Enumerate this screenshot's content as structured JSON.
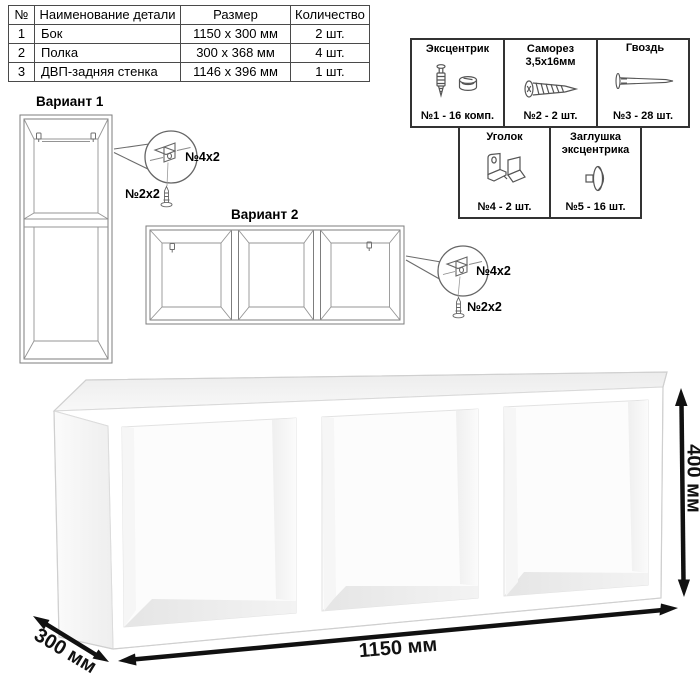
{
  "parts_table": {
    "headers": [
      "№",
      "Наименование детали",
      "Размер",
      "Количество"
    ],
    "rows": [
      {
        "num": "1",
        "name": "Бок",
        "size": "1150 х 300 мм",
        "qty": "2 шт."
      },
      {
        "num": "2",
        "name": "Полка",
        "size": "300 х 368 мм",
        "qty": "4 шт."
      },
      {
        "num": "3",
        "name": "ДВП-задняя стенка",
        "size": "1146 х 396 мм",
        "qty": "1 шт."
      }
    ]
  },
  "hardware": {
    "row1": [
      {
        "title": "Эксцентрик",
        "icon": "cam-bolt-icon",
        "count": "№1 - 16 комп."
      },
      {
        "title": "Саморез 3,5х16мм",
        "icon": "screw-icon",
        "count": "№2 - 2 шт."
      },
      {
        "title": "Гвоздь",
        "icon": "nail-icon",
        "count": "№3 - 28 шт."
      }
    ],
    "row2": [
      {
        "title": "Уголок",
        "icon": "corner-bracket-icon",
        "count": "№4 - 2 шт."
      },
      {
        "title": "Заглушка эксцентрика",
        "icon": "cap-icon",
        "count": "№5 - 16 шт."
      }
    ]
  },
  "variants": {
    "v1": {
      "label": "Вариант 1",
      "bracket_note": "№4х2",
      "screw_note": "№2х2"
    },
    "v2": {
      "label": "Вариант 2",
      "bracket_note": "№4х2",
      "screw_note": "№2х2"
    }
  },
  "dimensions": {
    "width": "1150 мм",
    "depth": "300 мм",
    "height": "400 мм"
  },
  "colors": {
    "background": "#ffffff",
    "drawing_line": "#7d7d7d",
    "dimension_color": "#111111",
    "text": "#000000"
  }
}
